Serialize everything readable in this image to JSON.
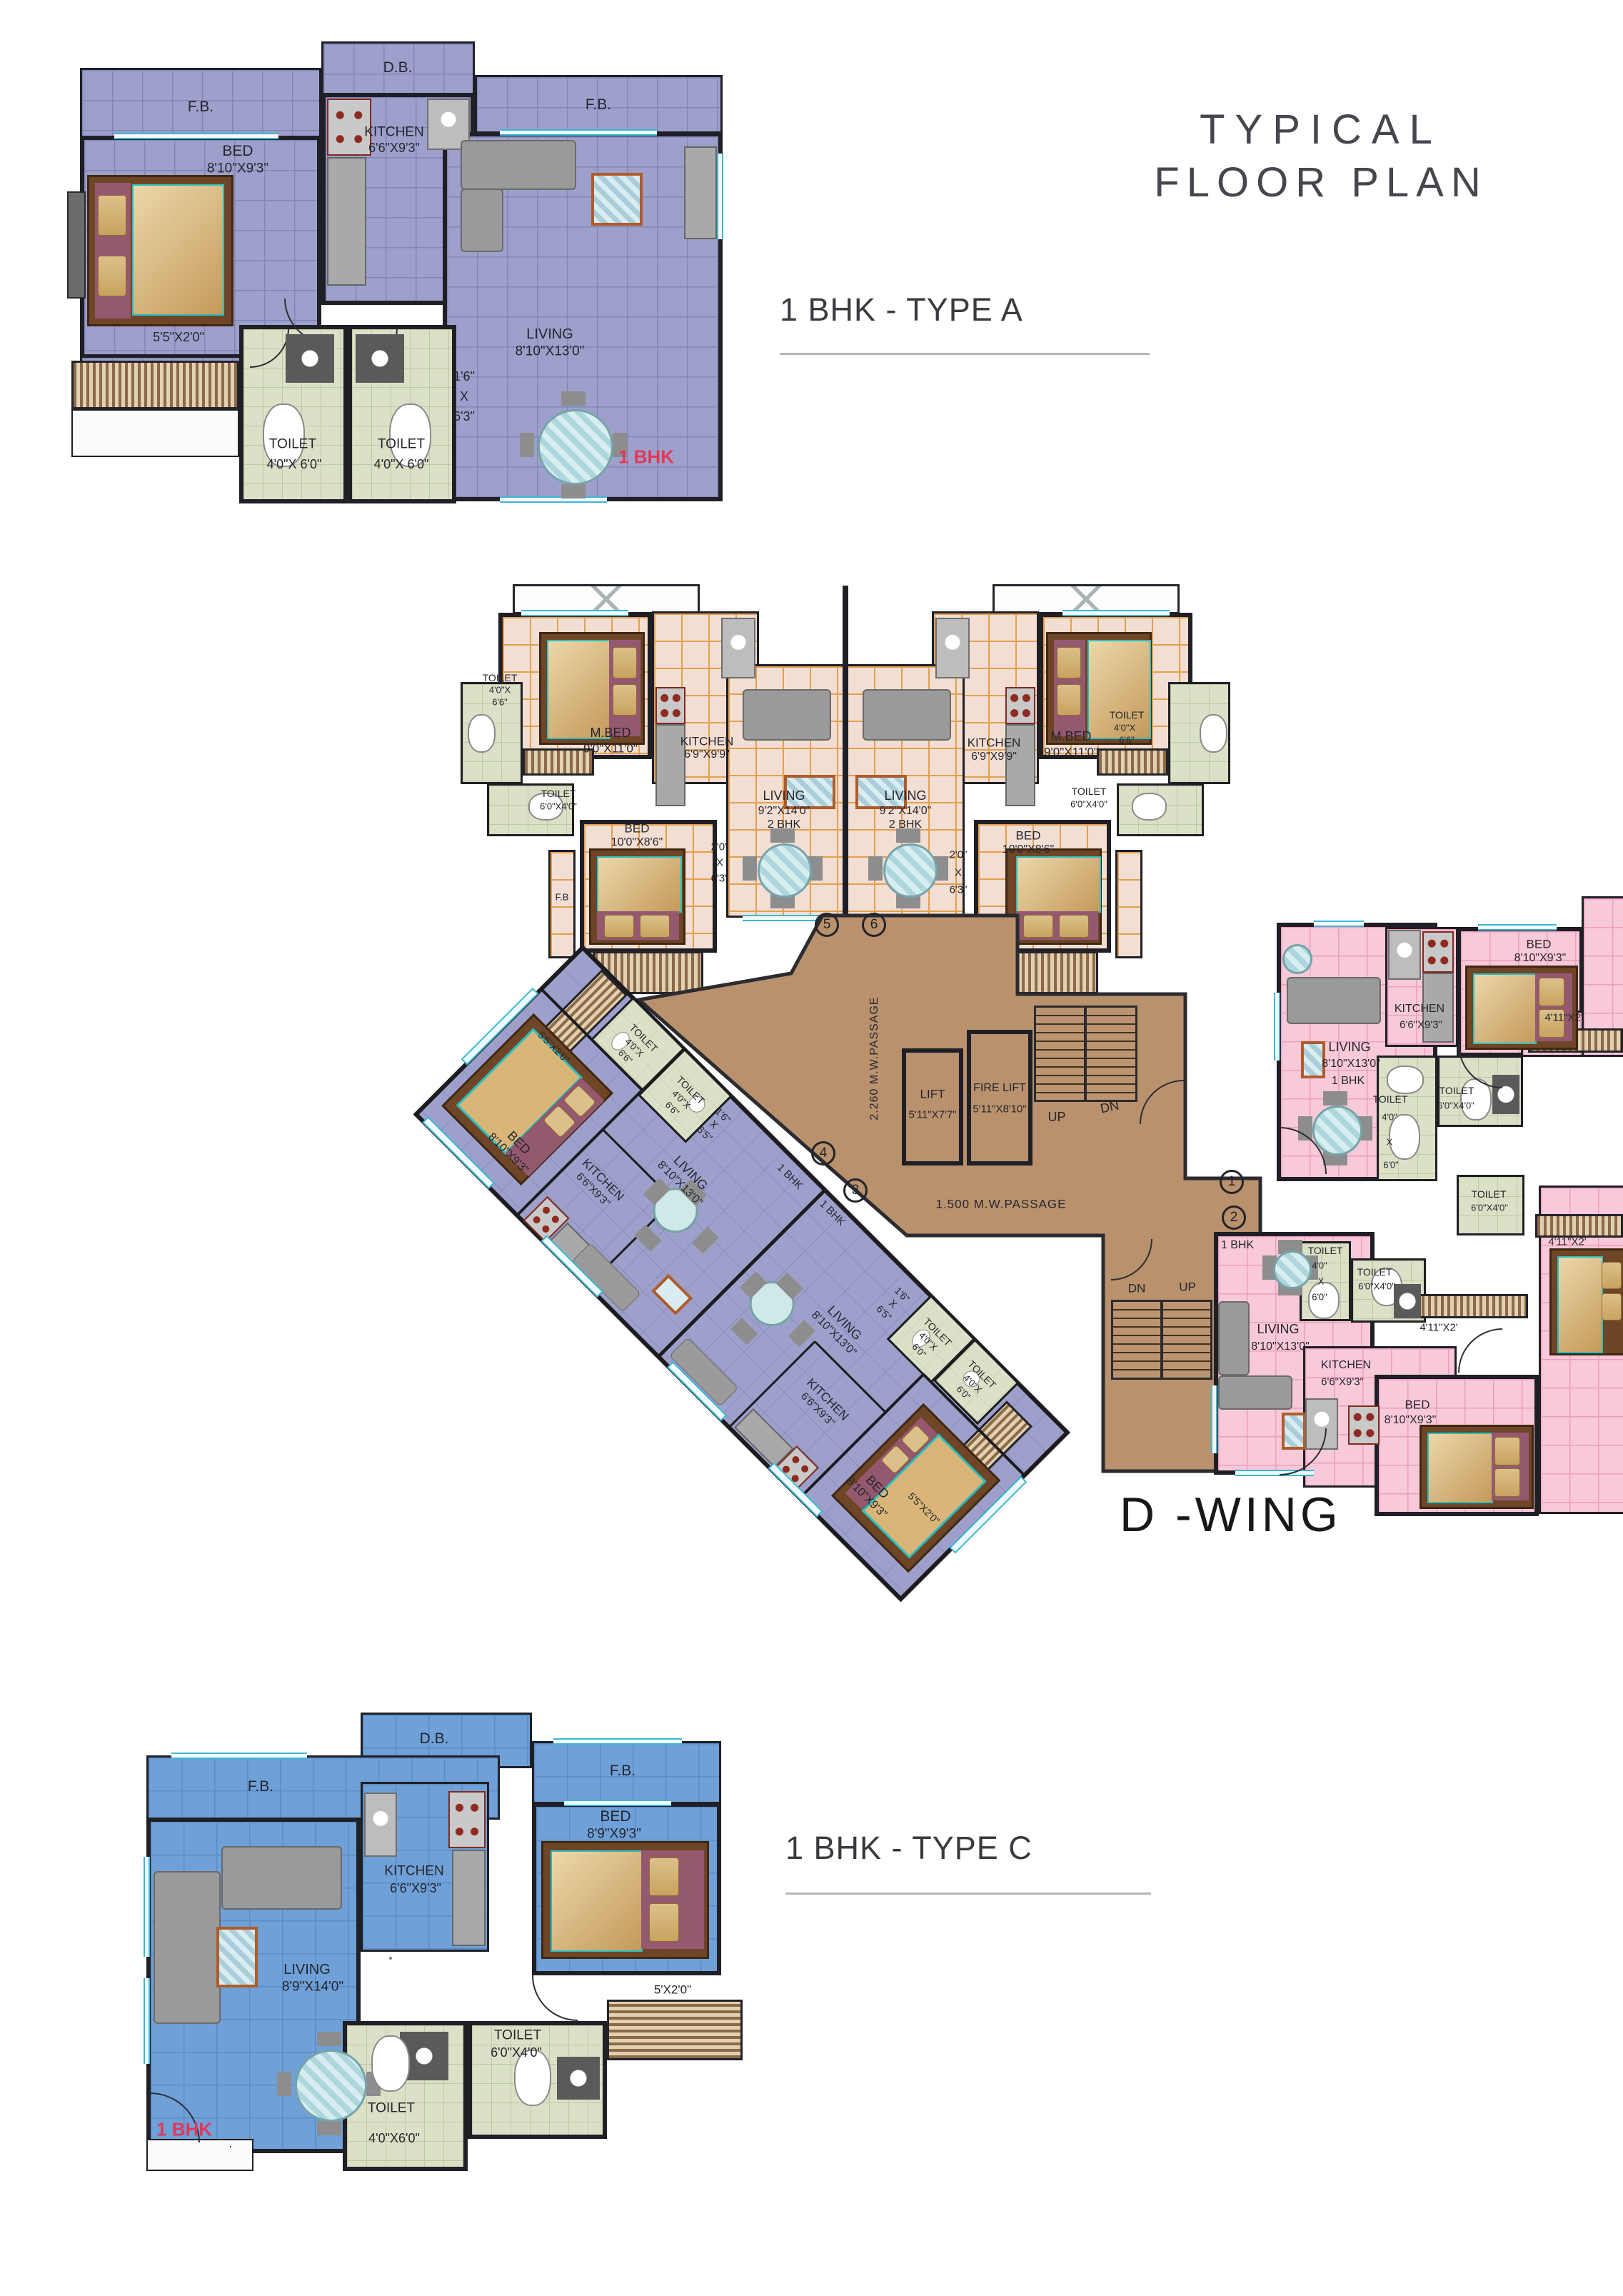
{
  "title": {
    "line1": "TYPICAL",
    "line2": "FLOOR  PLAN"
  },
  "sections": {
    "type_a": "1 BHK - TYPE A",
    "type_c": "1 BHK - TYPE C",
    "wing_name": "D -WING"
  },
  "colors": {
    "lavender": "#9da0cb",
    "peach": "#f3ded3",
    "pink": "#f8c9d9",
    "blue": "#6fa0d8",
    "toilet_green": "#dbe1c7",
    "passage_brown": "#b9916d",
    "red_tag": "#e0395a",
    "window_cyan": "#3fb6d4"
  },
  "type_a": {
    "fb_left": "F.B.",
    "db": "D.B.",
    "fb_right": "F.B.",
    "bed": {
      "name": "BED",
      "dim": "8'10\"X9'3\""
    },
    "kitchen": {
      "name": "KITCHEN",
      "dim": "6'6\"X9'3\""
    },
    "living": {
      "name": "LIVING",
      "dim": "8'10\"X13'0\""
    },
    "wardrobe": "5'5\"X2'0\"",
    "toilet1": {
      "name": "TOILET",
      "dim": "4'0\"X 6'0\""
    },
    "toilet2": {
      "name": "TOILET",
      "dim": "4'0\"X 6'0\""
    },
    "passage": [
      "1'6\"",
      "X",
      "6'3\""
    ],
    "tag": "1 BHK"
  },
  "bhk2_left": {
    "mbed": {
      "name": "M.BED",
      "dim": "9'0\"X11'0\""
    },
    "kitchen": {
      "name": "KITCHEN",
      "dim": "6'9\"X9'9\""
    },
    "living": {
      "name": "LIVING",
      "dim": "9'2\"X14'0\"",
      "type": "2 BHK"
    },
    "bed": {
      "name": "BED",
      "dim": "10'0\"X8'6\""
    },
    "toilet1": [
      "TOILET",
      "4'0\"X",
      "6'6\""
    ],
    "toilet2": {
      "name": "TOILET",
      "dim": "6'0\"X4'0\""
    },
    "fb": "F.B",
    "balc": [
      "2'0\"",
      "X",
      "6'3\""
    ]
  },
  "bhk2_right": {
    "mbed": {
      "name": "M.BED",
      "dim": "9'0\"X11'0\""
    },
    "kitchen": {
      "name": "KITCHEN",
      "dim": "6'9\"X9'9\""
    },
    "living": {
      "name": "LIVING",
      "dim": "9'2\"X14'0\"",
      "type": "2 BHK"
    },
    "bed": {
      "name": "BED",
      "dim": "10'0\"X8'6\""
    },
    "toilet1": [
      "TOILET",
      "4'0\"X",
      "6'6\""
    ],
    "toilet2": {
      "name": "TOILET",
      "dim": "6'0\"X4'0\""
    },
    "balc": [
      "2'0\"",
      "X",
      "6'3\""
    ]
  },
  "core": {
    "lift": {
      "name": "LIFT",
      "dim": "5'11\"X7'7\""
    },
    "fire_lift": {
      "name": "FIRE LIFT",
      "dim": "5'11\"X8'10\""
    },
    "up": "UP",
    "dn": "DN",
    "up2": "UP",
    "dn2": "DN",
    "passage_v": "2.260 M.W.PASSAGE",
    "passage_h": "1.500 M.W.PASSAGE",
    "circles": [
      "1",
      "2",
      "3",
      "4",
      "5",
      "6"
    ]
  },
  "pink_top": {
    "living": {
      "name": "LIVING",
      "dim": "8'10\"X13'0\"",
      "type": "1 BHK"
    },
    "kitchen": {
      "name": "KITCHEN",
      "dim": "6'6\"X9'3\""
    },
    "bed": {
      "name": "BED",
      "dim": "8'10\"X9'3\""
    },
    "balc": "4'11\"X2'",
    "toilet1": [
      "TOILET",
      "4'0\"",
      "X",
      "6'0\""
    ],
    "toilet2": {
      "name": "TOILET",
      "dim": "6'0\"X4'0\""
    }
  },
  "pink_bottom": {
    "tag": "1 BHK",
    "living": {
      "name": "LIVING",
      "dim": "8'10\"X13'0\""
    },
    "kitchen": {
      "name": "KITCHEN",
      "dim": "6'6\"X9'3\""
    },
    "bed": {
      "name": "BED",
      "dim": "8'10\"X9'3\""
    },
    "balc": "4'11\"X2'",
    "toilet1": [
      "TOILET",
      "4'0\"",
      "X",
      "6'0\""
    ],
    "toilet2": {
      "name": "TOILET",
      "dim": "6'0\"X4'0\""
    }
  },
  "pink_partial": {
    "toilet": {
      "name": "TOILET",
      "dim": "6'0\"X4'0\""
    },
    "balc": "4'11\"X2'"
  },
  "wing1": {
    "tag": "1 BHK",
    "wardrobe": "5'5\"X2'0\"",
    "bed": {
      "name": "BED",
      "dim": "8'10\"X9'3\""
    },
    "kitchen": {
      "name": "KITCHEN",
      "dim": "6'6\"X9'3\""
    },
    "living": {
      "name": "LIVING",
      "dim": "8'10\"X13'0\""
    },
    "toilet1": [
      "TOILET",
      "4'0\"X",
      "6'6\""
    ],
    "toilet2": [
      "TOILET",
      "4'0\"X",
      "6'6\""
    ],
    "passage": [
      "1'6\"",
      "X",
      "6'5\""
    ]
  },
  "wing2": {
    "tag": "1 BHK",
    "wardrobe": "5'5\"X2'0\"",
    "bed": {
      "name": "BED",
      "dim": "8'10\"X9'3\""
    },
    "kitchen": {
      "name": "KITCHEN",
      "dim": "6'6\"X9'3\""
    },
    "living": {
      "name": "LIVING",
      "dim": "8'10\"X13'0\""
    },
    "toilet1": [
      "TOILET",
      "4'0\"X",
      "6'0\""
    ],
    "toilet2": [
      "TOILET",
      "4'0\"X",
      "6'0\""
    ],
    "passage": [
      "1'6\"",
      "X",
      "6'5\""
    ]
  },
  "type_c": {
    "db": "D.B.",
    "fb_left": "F.B.",
    "fb_right": "F.B.",
    "kitchen": {
      "name": "KITCHEN",
      "dim": "6'6\"X9'3\""
    },
    "living": {
      "name": "LIVING",
      "dim": "8'9\"X14'0\""
    },
    "bed": {
      "name": "BED",
      "dim": "8'9\"X9'3\""
    },
    "wardrobe": "5'X2'0\"",
    "toilet1": {
      "name": "TOILET",
      "dim": "4'0\"X6'0\""
    },
    "toilet2": {
      "name": "TOILET",
      "dim": "6'0\"X4'0\""
    },
    "tag": "1 BHK"
  }
}
